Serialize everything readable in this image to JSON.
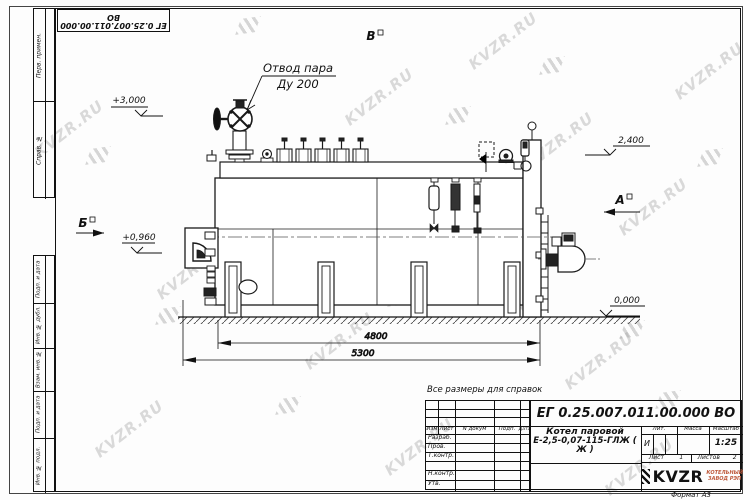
{
  "stamp_top": {
    "doc_number": "ЕГ 0.25.007.011.00.000 ВО"
  },
  "margin": {
    "top_labels": [
      "Перв. примен.",
      "Справ. №"
    ],
    "bottom_labels": [
      "Подп. и дата",
      "Инв. № дубл.",
      "Взам. инв. №",
      "Подп. и дата",
      "Инв. № подл."
    ]
  },
  "watermark": {
    "text": "KVZR.RU"
  },
  "drawing": {
    "callout_line1": "Отвод пара",
    "callout_line2": "Ду 200",
    "dim_4800": "4800",
    "dim_5300": "5300",
    "elev_3000": "+3,000",
    "elev_2400": "2,400",
    "elev_0960": "+0,960",
    "elev_0000": "0,000",
    "view_a": "А",
    "view_b": "Б",
    "view_v": "В"
  },
  "note": "Все размеры для справок",
  "title_block": {
    "doc_number": "ЕГ 0.25.007.011.00.000 ВО",
    "name_line1": "Котел паровой",
    "name_line2": "Е-2,5-0,07-115-ГЛЖ ( Ж )",
    "col_izm": "Изм",
    "col_list": "Лист",
    "col_ndoc": "N докум",
    "col_podp": "Подп.",
    "col_data": "Дата",
    "row_razrab": "Разраб.",
    "row_prov": "Пров.",
    "row_tkontr": "Т.контр.",
    "row_nkontr": "Н.контр.",
    "row_utv": "Утв.",
    "lit_label": "Лит.",
    "massa_label": "Масса",
    "scale_label": "Масштаб",
    "lit_value": "И",
    "scale_value": "1:25",
    "sheet_label": "Лист",
    "sheet_value": "1",
    "sheets_label": "Листов",
    "sheets_value": "2",
    "logo": "KVZR",
    "logo_sub1": "КОТЕЛЬНЫЙ",
    "logo_sub2": "ЗАВОД РЭП",
    "format_label": "Формат А3"
  }
}
